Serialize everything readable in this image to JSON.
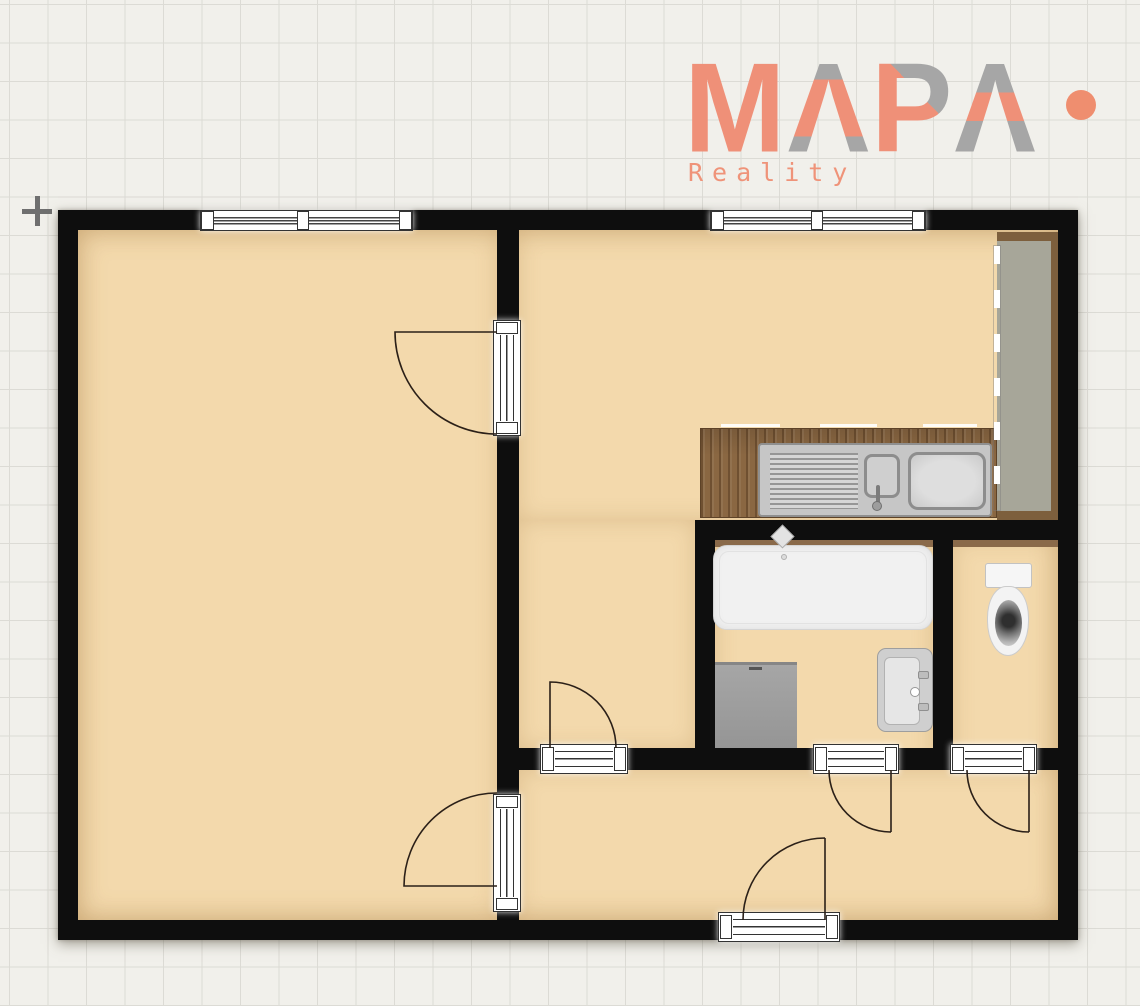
{
  "logo": {
    "brand": "MAPA",
    "letters": [
      "M",
      "Λ",
      "P",
      "Λ"
    ],
    "subtitle": "Reality",
    "accent_color": "#ef9078",
    "secondary_color": "#a6a6a6",
    "icons": {
      "logo_dot": "filled-circle"
    }
  },
  "canvas": {
    "icons": {
      "crosshair_marker": "plus"
    }
  },
  "floorplan": {
    "wall_color": "#0e0e0e",
    "floor_color": "#f3d9ac",
    "wood_color": "#8a6742",
    "cabinet_color": "#a7a699",
    "rooms": [
      "living-room",
      "kitchen",
      "bathroom",
      "wc",
      "hallway"
    ],
    "fixtures": [
      "kitchen-counter",
      "kitchen-sink",
      "tall-cabinet",
      "bathtub",
      "washing-machine",
      "wash-basin",
      "toilet"
    ],
    "openings": [
      "living-room-window",
      "kitchen-window",
      "living-room-upper-door",
      "living-room-lower-door",
      "kitchen-hall-door",
      "bathroom-door",
      "wc-door",
      "entry-door"
    ]
  }
}
